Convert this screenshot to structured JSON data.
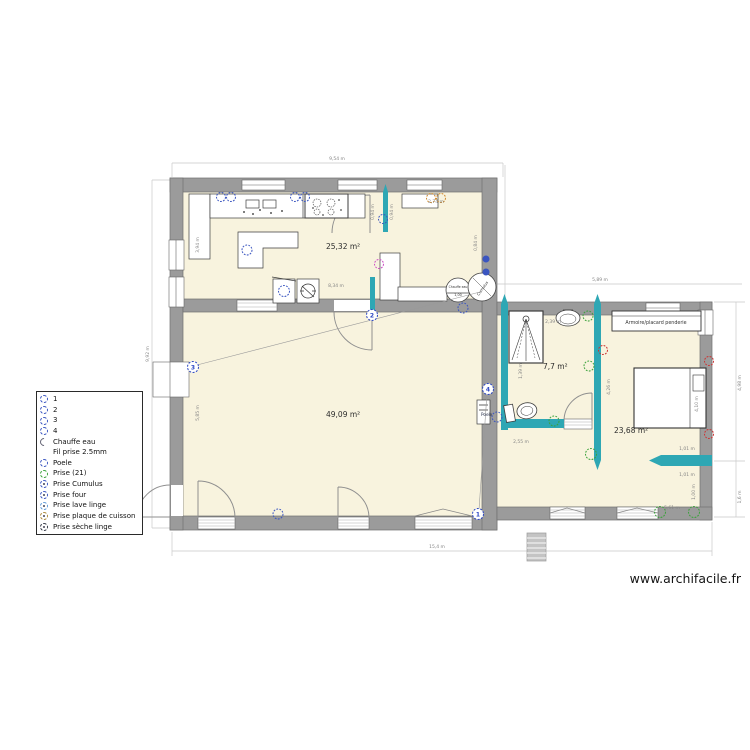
{
  "watermark": "www.archifacile.fr",
  "rooms": {
    "kitchen_area": "25,32 m²",
    "living_area": "49,09 m²",
    "bathroom_area": "7,7 m²",
    "bedroom_area": "23,68 m²"
  },
  "labels": {
    "armoire": "Armoire/placard penderie",
    "chauffe_eau": "Chauffe eau",
    "chauffe_dim": "1,00",
    "cumulus": "Cumulus",
    "poele": "Poele"
  },
  "markers": {
    "m1": "1",
    "m2": "2",
    "m3": "3",
    "m4": "4"
  },
  "dims": {
    "top": "9,54 m",
    "left": "9,92 m",
    "bottom": "15,4 m",
    "right_section": "5,89 m",
    "right_upper": "4,98 m",
    "right_lower": "1,6 m",
    "kitchen_width": "8,34 m",
    "living_height": "5,85 m",
    "cabinet": "3,94 m",
    "sideboard": "2,74 m",
    "door_a": "0,94 m",
    "door_b": "0,94 m",
    "kitchen_right": "0,84 m",
    "bath_top": "2,39 m",
    "shower": "1,39 m",
    "divider": "4,26 m",
    "bath_bottom": "2,55 m",
    "bed_gap_upper": "1,01 m",
    "bed_gap_lower": "1,01 m",
    "bedroom_width": "5,61 m",
    "bed_length": "4,10 m",
    "bedroom_right": "1,00 m"
  },
  "legend": {
    "items": [
      {
        "label": "1",
        "type": "socket-blue"
      },
      {
        "label": "2",
        "type": "socket-blue"
      },
      {
        "label": "3",
        "type": "socket-blue"
      },
      {
        "label": "4",
        "type": "socket-blue"
      },
      {
        "label": "Chauffe eau",
        "type": "heater-arc"
      },
      {
        "label": "Fil prise 2.5mm",
        "type": "none"
      },
      {
        "label": "Poele",
        "type": "socket-blue"
      },
      {
        "label": "Prise (21)",
        "type": "socket-green"
      },
      {
        "label": "Prise Cumulus",
        "type": "socket-blue-dot"
      },
      {
        "label": "Prise four",
        "type": "socket-blue-dot"
      },
      {
        "label": "Prise lave linge",
        "type": "socket-lightblue-dot"
      },
      {
        "label": "Prise plaque de cuisson",
        "type": "socket-orange-dot"
      },
      {
        "label": "Prise sèche linge",
        "type": "socket-dark-dot"
      }
    ]
  },
  "colors": {
    "wall": "#9b9b9b",
    "floor": "#f8f3de",
    "partition_teal": "#2ea7b4",
    "socket_blue": "#3a55c0",
    "socket_green": "#3aa23a",
    "socket_orange": "#cf8a2e",
    "socket_red": "#cc3333",
    "socket_magenta": "#cc4fc4",
    "marker_blue": "#2b46c4"
  }
}
